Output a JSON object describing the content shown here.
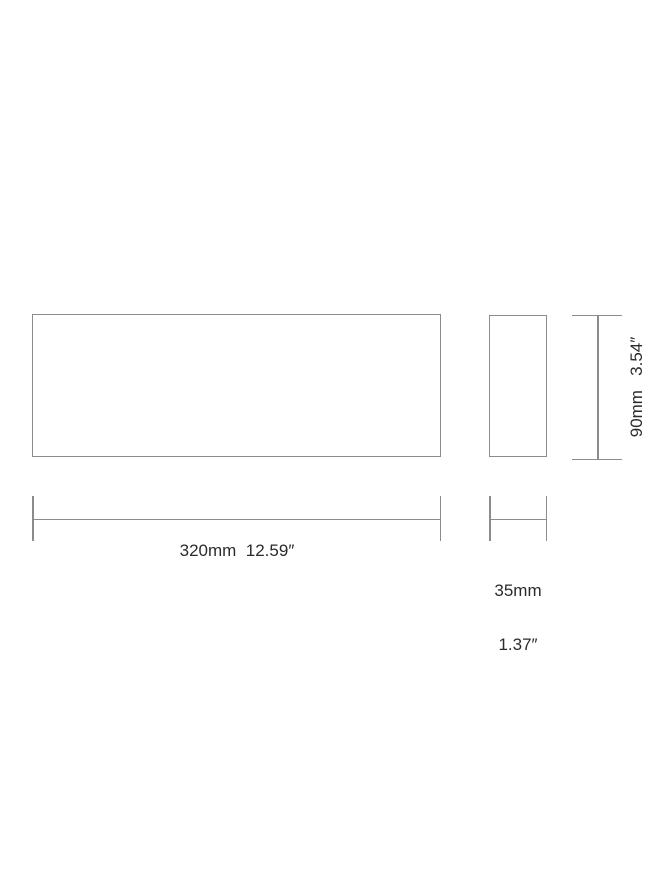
{
  "diagram": {
    "background": "#ffffff",
    "line_color": "#8c8c8c",
    "text_color": "#2b2b2b",
    "views": {
      "front_view": "front-elevation-outline",
      "side_view": "side-profile-outline"
    },
    "width_dimension": {
      "label": "320mm  12.59″"
    },
    "depth_dimension": {
      "label_mm": "35mm",
      "label_in": "1.37″"
    },
    "height_dimension": {
      "label": "90mm   3.54″"
    }
  }
}
